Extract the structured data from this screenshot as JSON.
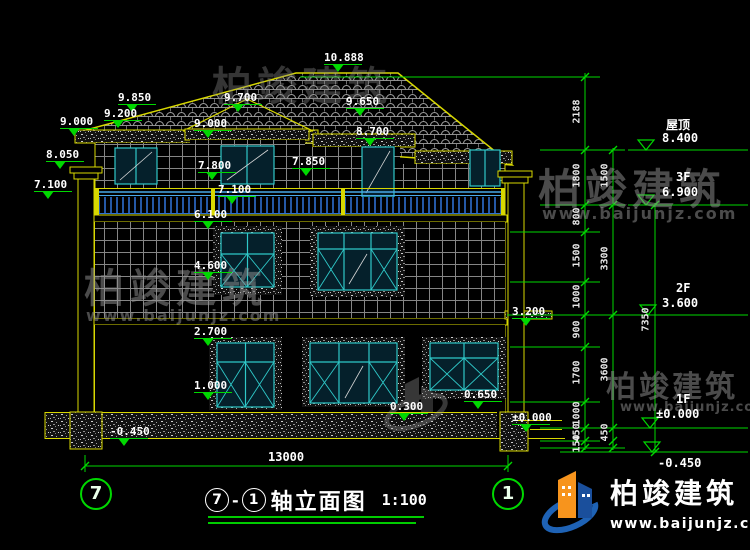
{
  "title": {
    "axis_a": "7",
    "axis_b": "1",
    "name": "轴立面图",
    "scale": "1:100"
  },
  "axes": {
    "left": "7",
    "right": "1"
  },
  "overall_dim": "13000",
  "elevations": {
    "ridge": "10.888",
    "eave_l1": "9.850",
    "eave_l2": "9.200",
    "eave_l3": "9.000",
    "gable_peak": "9.700",
    "gable_eave": "9.000",
    "eave_r1": "9.650",
    "eave_c": "8.700",
    "capital": "8.050",
    "canopy_r": "7.850",
    "win3_top": "7.800",
    "balc_l": "7.100",
    "balc_c": "7.100",
    "win2_top": "6.100",
    "win2_sill": "4.600",
    "side_canopy": "3.200",
    "win1_top": "2.700",
    "win1_sill": "1.000",
    "plinth": "0.300",
    "porch": "0.650",
    "zero": "±0.000",
    "grade": "-0.450"
  },
  "levels": {
    "roof": {
      "label": "屋顶",
      "value": "8.400"
    },
    "f3": {
      "label": "3F",
      "value": "6.900"
    },
    "f2": {
      "label": "2F",
      "value": "3.600"
    },
    "f1": {
      "label": "1F",
      "value": "±0.000"
    },
    "base": {
      "label": "",
      "value": "-0.450"
    }
  },
  "dims": {
    "inner": [
      "2188",
      "1800",
      "800",
      "1500",
      "1000",
      "900",
      "1700",
      "1000",
      "450",
      "150"
    ],
    "mid": [
      "1500",
      "3300",
      "3600",
      "450"
    ],
    "outer": [
      "7350"
    ]
  },
  "logo": {
    "name": "柏竣建筑",
    "url": "www.baijunjz.com"
  },
  "watermark": {
    "name": "柏竣建筑",
    "url": "www.baijunjz.com"
  },
  "colors": {
    "dimension": "#00d800",
    "outline": "#d8d800",
    "window": "#2fc8c8",
    "railing": "#2e6fd0",
    "text": "#ffffff"
  }
}
